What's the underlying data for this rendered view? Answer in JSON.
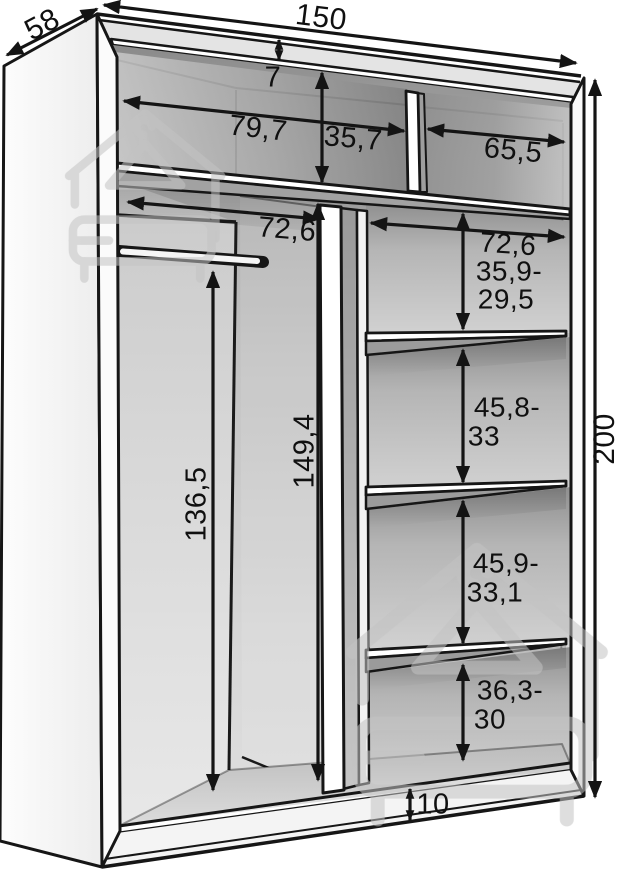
{
  "diagram": {
    "kind": "wardrobe-interior-dimension-drawing"
  },
  "dims": {
    "depth": "58",
    "width": "150",
    "top_gap": "7",
    "top_left_compartment_width": "79,7",
    "top_compartment_height": "35,7",
    "top_right_compartment_width": "65,5",
    "left_section_width": "72,6",
    "right_section_width": "72,6",
    "right_gap_top": {
      "line1": "35,9-",
      "line2": "29,5"
    },
    "right_gap_upper_middle": {
      "line1": "45,8-",
      "line2": "33"
    },
    "right_gap_lower_middle": {
      "line1": "45,9-",
      "line2": "33,1"
    },
    "right_gap_bottom": {
      "line1": "36,3-",
      "line2": "30"
    },
    "rail_height": "136,5",
    "left_section_height": "149,4",
    "total_height": "200",
    "base_height": "10"
  },
  "colors": {
    "outline": "#161616",
    "dimension": "#141414",
    "text": "#101010",
    "watermark": "#c3c3c3",
    "background": "#ffffff",
    "panel": "#fbfbfb"
  }
}
